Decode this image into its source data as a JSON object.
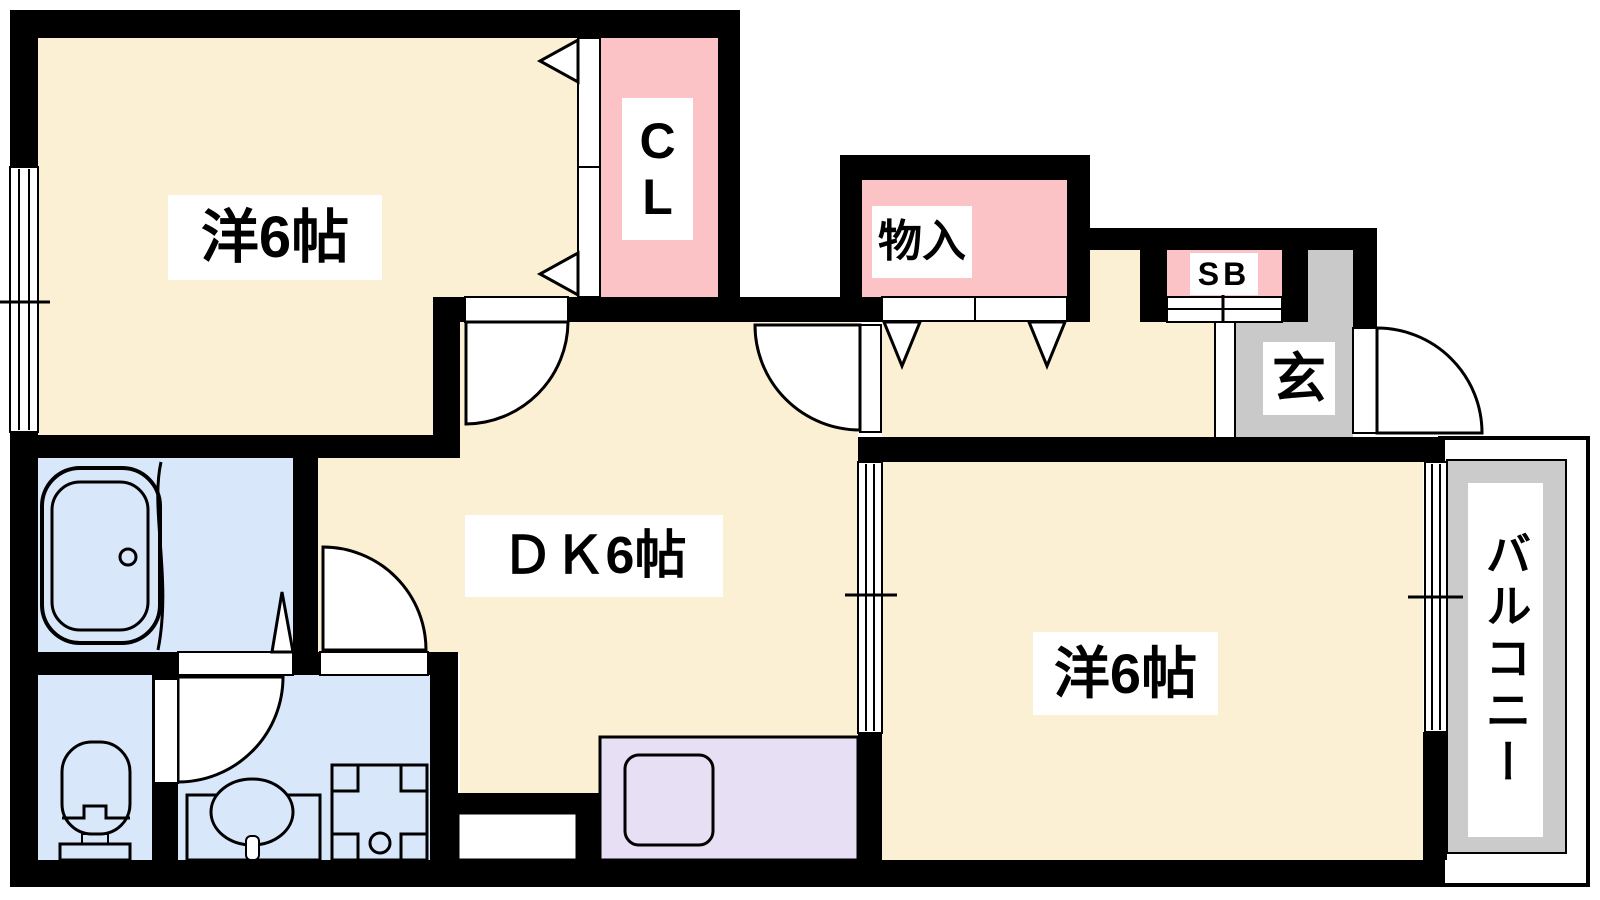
{
  "plan_title": "1DK apartment floor plan",
  "colors": {
    "wall": "#000000",
    "room_cream": "#FBF0D4",
    "closet_pink": "#FBC3C6",
    "wet_area_blue": "#D9E7FA",
    "kitchen_lavender": "#E7DFF3",
    "entry_gray": "#C9C9C9",
    "balcony_gray": "#CBCBCB",
    "line": "#000000",
    "label_bg": "#FFFFFF",
    "text": "#000000"
  },
  "labels": {
    "bedroom_top_left": "洋6帖",
    "closet": "CL",
    "storage": "物入",
    "shoe_box": "SB",
    "entry": "玄",
    "dining_kitchen": "ＤＫ6帖",
    "bedroom_right": "洋6帖",
    "balcony": "バルコニー"
  }
}
